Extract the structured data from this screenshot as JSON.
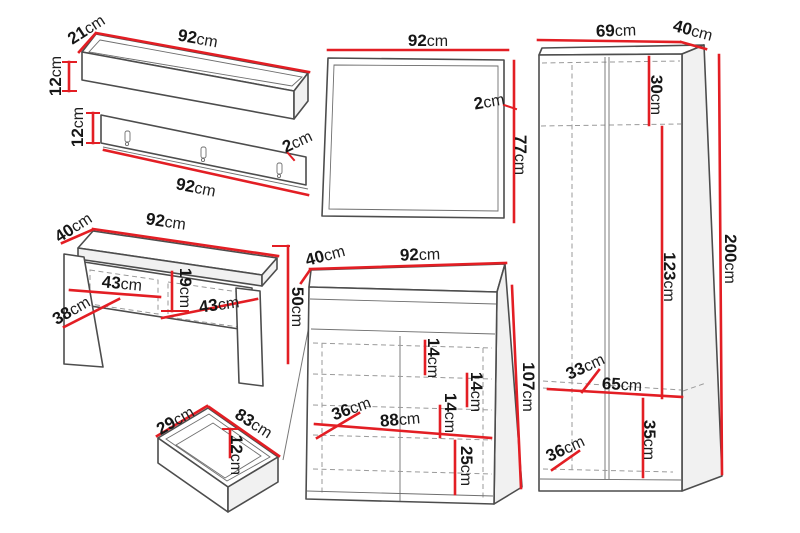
{
  "figure": "hallway-furniture-set-dimension-diagram",
  "unit": "cm",
  "colors": {
    "dimension_line": "#e31e24",
    "outline": "#4d4d4d",
    "hidden_line": "#9a9a9a",
    "label_text": "#161616",
    "background": "#ffffff"
  },
  "pieces": {
    "wall_shelf": {
      "depth": {
        "v": "21",
        "u": "cm"
      },
      "width": {
        "v": "92",
        "u": "cm"
      },
      "height": {
        "v": "12",
        "u": "cm"
      }
    },
    "coat_panel": {
      "height": {
        "v": "12",
        "u": "cm"
      },
      "width": {
        "v": "92",
        "u": "cm"
      },
      "thickness": {
        "v": "2",
        "u": "cm"
      }
    },
    "bench": {
      "depth": {
        "v": "40",
        "u": "cm"
      },
      "width": {
        "v": "92",
        "u": "cm"
      },
      "drawer_left": {
        "v": "43",
        "u": "cm"
      },
      "inner_depth": {
        "v": "38",
        "u": "cm"
      },
      "drawer_height": {
        "v": "19",
        "u": "cm"
      },
      "drawer_right": {
        "v": "43",
        "u": "cm"
      },
      "height": {
        "v": "50",
        "u": "cm"
      }
    },
    "drawer": {
      "depth": {
        "v": "29",
        "u": "cm"
      },
      "width": {
        "v": "83",
        "u": "cm"
      },
      "height": {
        "v": "12",
        "u": "cm"
      }
    },
    "mirror": {
      "width": {
        "v": "92",
        "u": "cm"
      },
      "thickness": {
        "v": "2",
        "u": "cm"
      },
      "height": {
        "v": "77",
        "u": "cm"
      }
    },
    "shoe_cabinet": {
      "depth": {
        "v": "40",
        "u": "cm"
      },
      "width": {
        "v": "92",
        "u": "cm"
      },
      "shelf_gap_1": {
        "v": "14",
        "u": "cm"
      },
      "shelf_gap_2": {
        "v": "14",
        "u": "cm"
      },
      "shelf_gap_3": {
        "v": "14",
        "u": "cm"
      },
      "inner_depth": {
        "v": "36",
        "u": "cm"
      },
      "inner_width": {
        "v": "88",
        "u": "cm"
      },
      "bottom_gap": {
        "v": "25",
        "u": "cm"
      },
      "height": {
        "v": "107",
        "u": "cm"
      }
    },
    "wardrobe": {
      "width": {
        "v": "69",
        "u": "cm"
      },
      "depth": {
        "v": "40",
        "u": "cm"
      },
      "top_section": {
        "v": "30",
        "u": "cm"
      },
      "middle_section": {
        "v": "123",
        "u": "cm"
      },
      "height": {
        "v": "200",
        "u": "cm"
      },
      "shelf_depth": {
        "v": "33",
        "u": "cm"
      },
      "inner_width": {
        "v": "65",
        "u": "cm"
      },
      "bottom_section": {
        "v": "35",
        "u": "cm"
      },
      "bottom_depth": {
        "v": "36",
        "u": "cm"
      }
    }
  }
}
